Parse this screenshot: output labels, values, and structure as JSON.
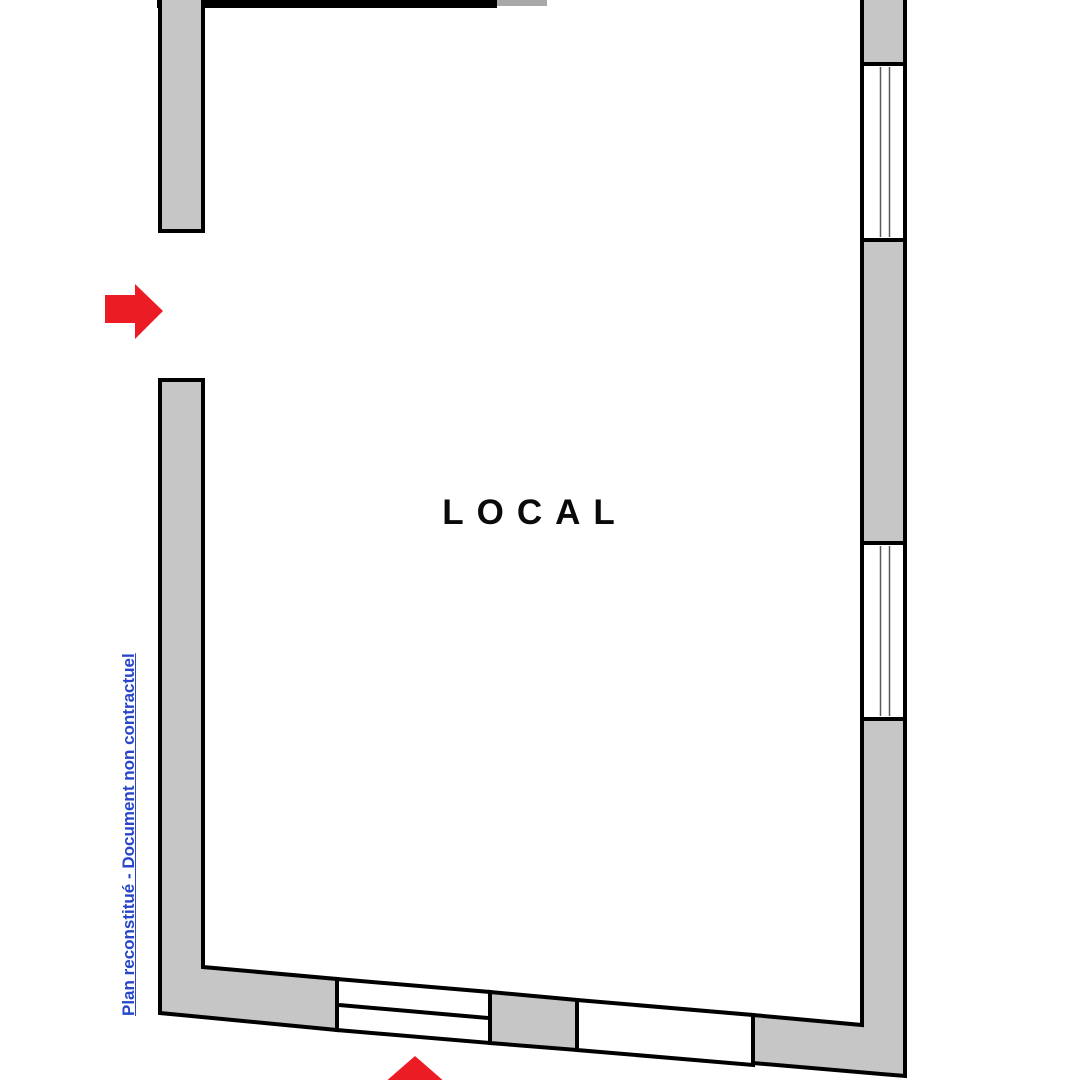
{
  "plan": {
    "room_label": "LOCAL",
    "watermark_text": "Plan reconstitué - Document non contractuel",
    "colors": {
      "wall_fill": "#c6c6c6",
      "opening_fill": "#ffffff",
      "outline": "#000000",
      "arrow_red": "#ec1c24",
      "watermark_blue": "#2946c8"
    },
    "arrows": [
      {
        "name": "entrance-arrow-left",
        "direction": "right"
      },
      {
        "name": "entrance-arrow-bottom",
        "direction": "up"
      }
    ],
    "features": {
      "right_wall_windows": 2,
      "bottom_wall_window": 1,
      "bottom_wall_opening": 1
    }
  }
}
